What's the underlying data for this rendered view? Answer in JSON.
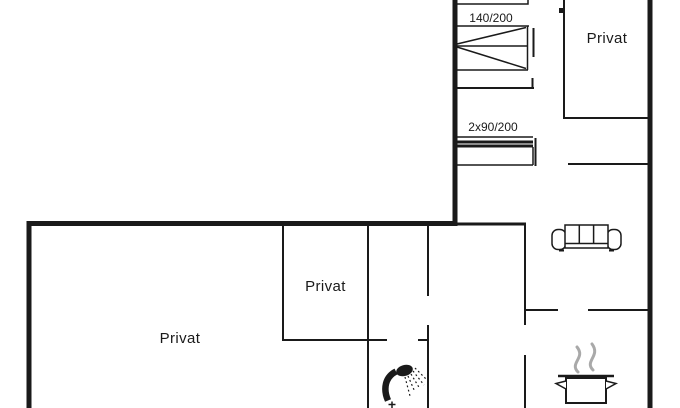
{
  "rooms": [
    {
      "id": "room-top-right",
      "label": "Privat"
    },
    {
      "id": "room-middle",
      "label": "Privat"
    },
    {
      "id": "room-bottom-left",
      "label": "Privat"
    }
  ],
  "beds": [
    {
      "id": "double-bed",
      "label": "140/200"
    },
    {
      "id": "twin-beds",
      "label": "2x90/200"
    }
  ],
  "icons": [
    {
      "name": "sofa-icon"
    },
    {
      "name": "shower-icon"
    },
    {
      "name": "cooking-pot-icon"
    },
    {
      "name": "steam-icon"
    },
    {
      "name": "bed-icon"
    }
  ],
  "colors": {
    "wall": "#1a1a1a",
    "background": "#ffffff",
    "steam": "#a9a9a9"
  }
}
